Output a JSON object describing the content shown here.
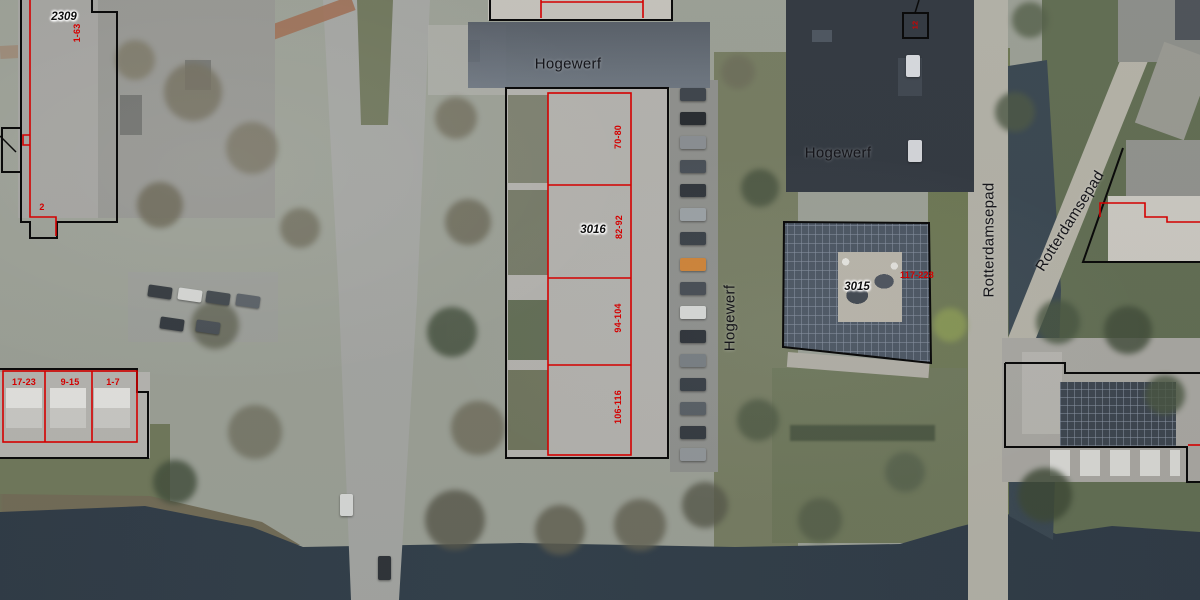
{
  "view": {
    "description": "Aerial photo with cadastral building outlines and address annotations",
    "streets": {
      "hogewerf": "Hogewerf",
      "rotterdamsepad": "Rotterdamsepad"
    },
    "parcels": {
      "b2309": {
        "number": "2309",
        "address_range": "1-63",
        "annex_number": "2"
      },
      "row_southwest": {
        "address_ranges": [
          "17-23",
          "9-15",
          "1-7"
        ]
      },
      "b3016": {
        "number": "3016",
        "address_ranges": [
          "70-80",
          "82-92",
          "94-104",
          "106-116"
        ]
      },
      "b3015": {
        "number": "3015",
        "address_range": "117-228"
      },
      "marker_northeast": {
        "address_range": "12"
      }
    },
    "colors": {
      "parcel_line_red": "#d40000",
      "building_outline_black": "#0b0b0b",
      "water": "#2c3843",
      "grass": "#6d7556",
      "road": "#a3a4a0"
    }
  }
}
